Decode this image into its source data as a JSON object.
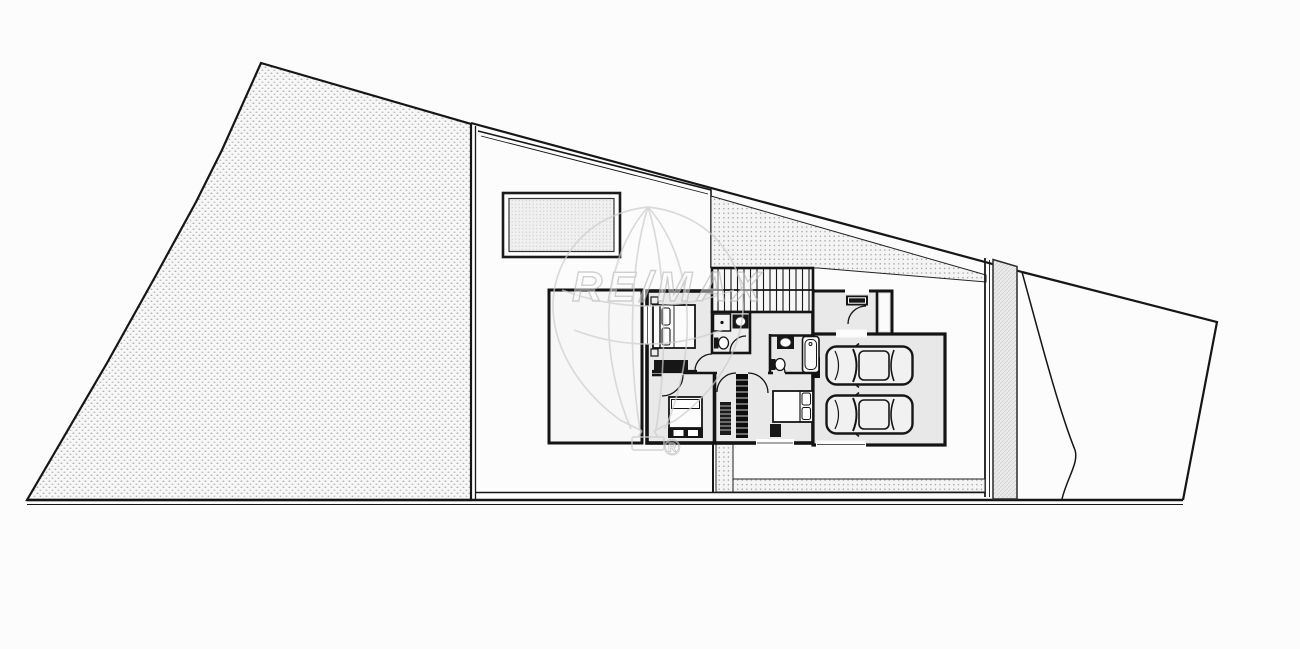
{
  "canvas": {
    "width_px": 1300,
    "height_px": 649,
    "background": "#fcfcfc"
  },
  "watermark": {
    "brand": "RE/MAX",
    "registered_symbol": "®"
  },
  "palette": {
    "line_dark": "#161616",
    "room_fill": "#e9e9e9",
    "terrace_fill": "#f7f7f7",
    "hatch_dot": "#b0b0b0",
    "walkway_dot": "#9f9f9f",
    "driveway_strip_fill": "#ebebeb",
    "watermark_stroke": "#c9c9c9"
  },
  "site": {
    "parcels": [
      {
        "name": "left-parcel",
        "texture": "dotted-hatch"
      },
      {
        "name": "middle-parcel-courtyard",
        "texture": "plain"
      },
      {
        "name": "right-parcel",
        "texture": "plain"
      }
    ],
    "features": [
      "pool",
      "exterior-stairs",
      "perimeter-walkway",
      "driveway-strip",
      "slope-line"
    ]
  },
  "house": {
    "rooms": [
      "terrace",
      "bedroom-top-left",
      "bathroom-top",
      "hallway",
      "entry",
      "bedroom-bottom-left",
      "bedroom-bottom-right",
      "bathroom-center",
      "garage"
    ],
    "furniture": [
      "double-bed",
      "single-bed",
      "double-bed",
      "dresser",
      "foot-bench",
      "wardrobe",
      "interior-staircase",
      "shower",
      "sink",
      "toilet",
      "bathtub",
      "entry-mat"
    ],
    "vehicle_count": 2
  }
}
